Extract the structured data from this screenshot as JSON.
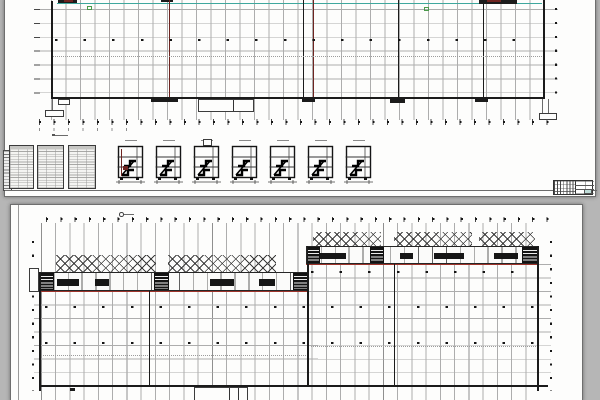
{
  "colors": {
    "canvas_bg": "#b6b6b6",
    "sheet_bg": "#fdfdfc",
    "grid_light": "#adadad",
    "wall": "#1b1b1b",
    "section_red": "#9e332a",
    "firewall_maroon": "#6e2420",
    "utility_teal": "#3fa79d",
    "marker_green": "#4b9a4b",
    "title_teal_cell": "#bedcd8"
  },
  "top_sheet": {
    "stair_section_count": 7,
    "schedule_table_count": 3,
    "has_title_block": true,
    "red_section_line_count": 2
  },
  "bottom_sheet": {
    "rooflight_band_segments": 5,
    "red_section_line_count": 2,
    "hall_column_dot_rows": 3
  }
}
